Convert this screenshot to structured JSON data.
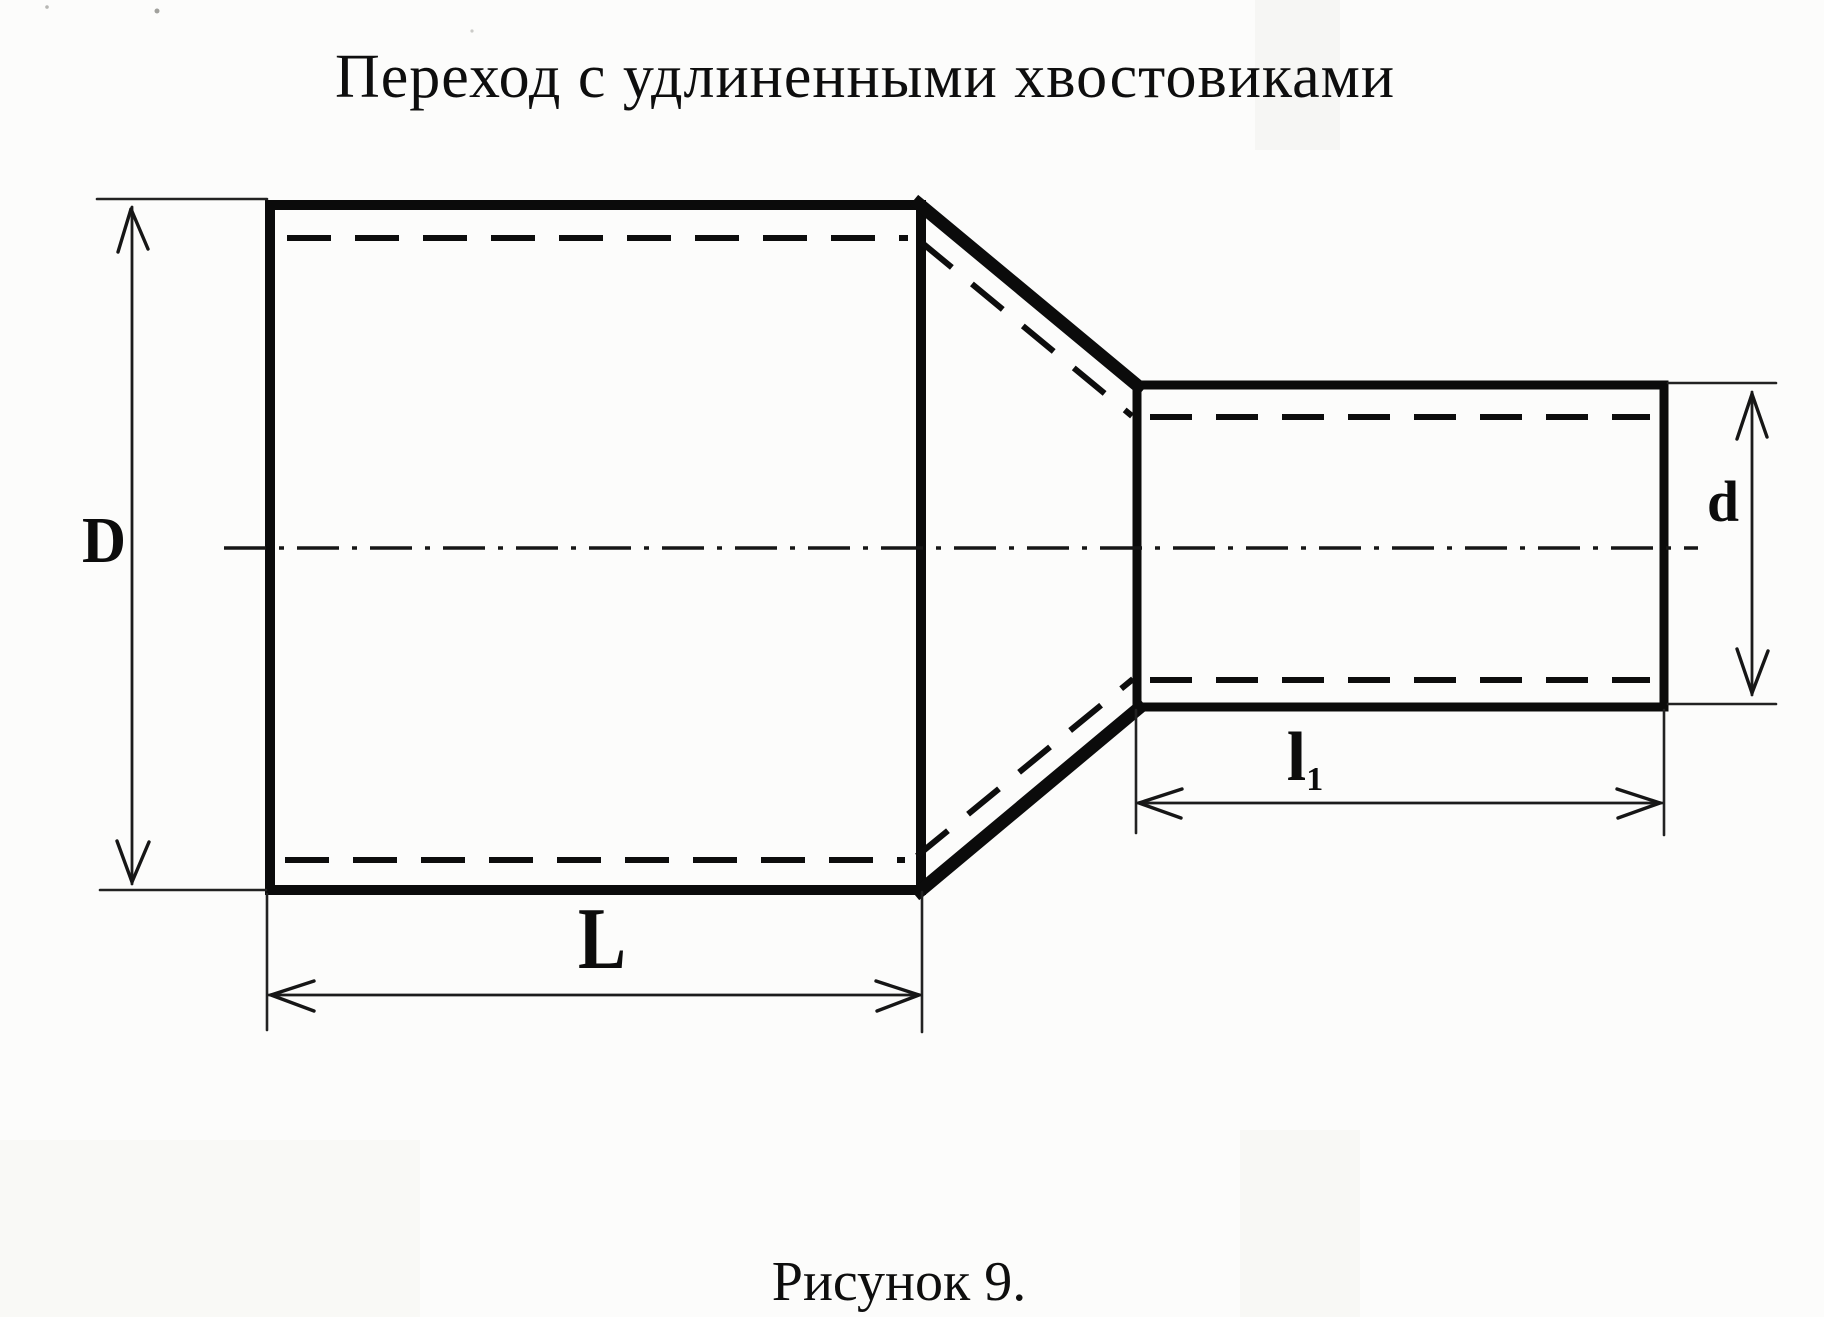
{
  "title": "Переход с удлиненными хвостовиками",
  "figure_caption": "Рисунок 9.",
  "dimension_labels": {
    "large_diameter": "D",
    "small_diameter": "d",
    "large_length": "L",
    "small_length": "l",
    "small_length_subscript": "1"
  }
}
